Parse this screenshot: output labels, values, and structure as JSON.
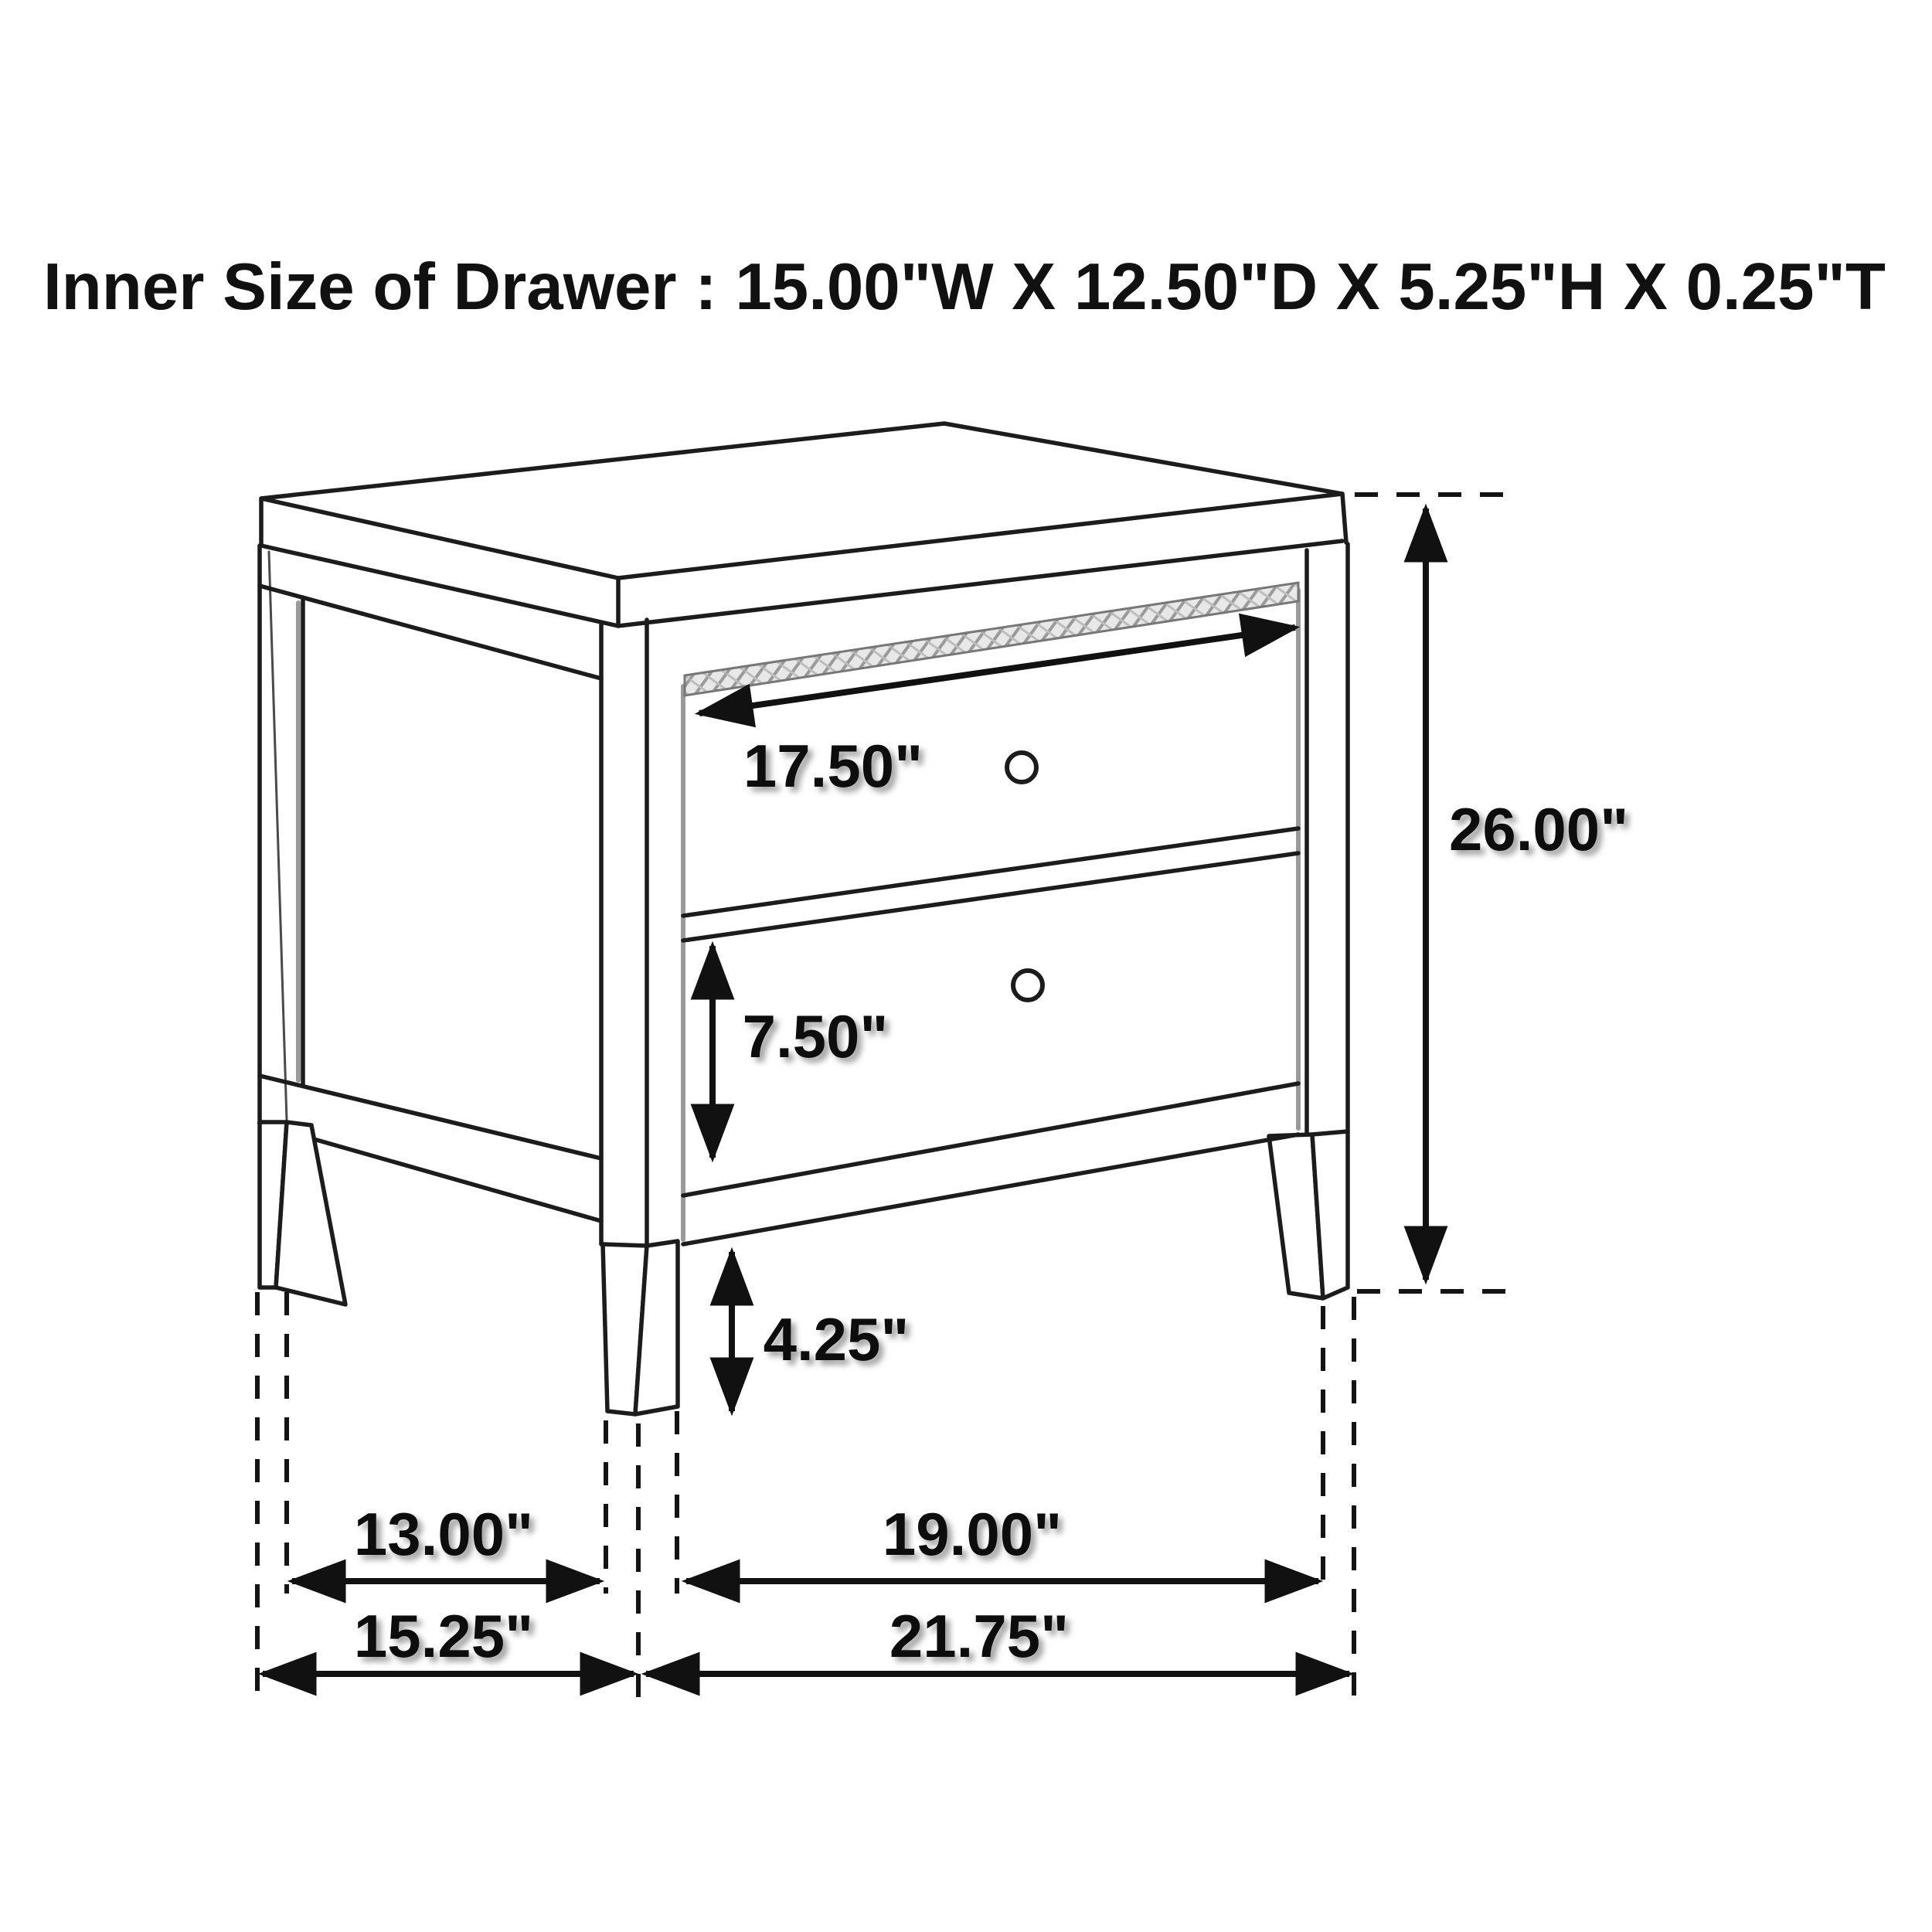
{
  "title": "Inner Size of Drawer : 15.00\"W X 12.50\"D X 5.25\"H X 0.25\"T",
  "diagram": {
    "type": "furniture-dimension-diagram",
    "subject": "two-drawer nightstand line drawing with dimension arrows",
    "units": "inches",
    "annotations": {
      "drawer_width": "17.50\"",
      "overall_height": "26.00\"",
      "bottom_drawer_height": "7.50\"",
      "leg_height": "4.25\"",
      "side_inner_span": "13.00\"",
      "front_inner_span": "19.00\"",
      "overall_depth": "15.25\"",
      "overall_width": "21.75\""
    },
    "inner_drawer_size": {
      "width": "15.00\"",
      "depth": "12.50\"",
      "height": "5.25\"",
      "thickness": "0.25\""
    },
    "colors": {
      "line": "#1c1c1c",
      "background": "#ffffff",
      "hatch_fill": "#e8e8e8",
      "hatch_stroke": "#9a9a9a"
    }
  }
}
